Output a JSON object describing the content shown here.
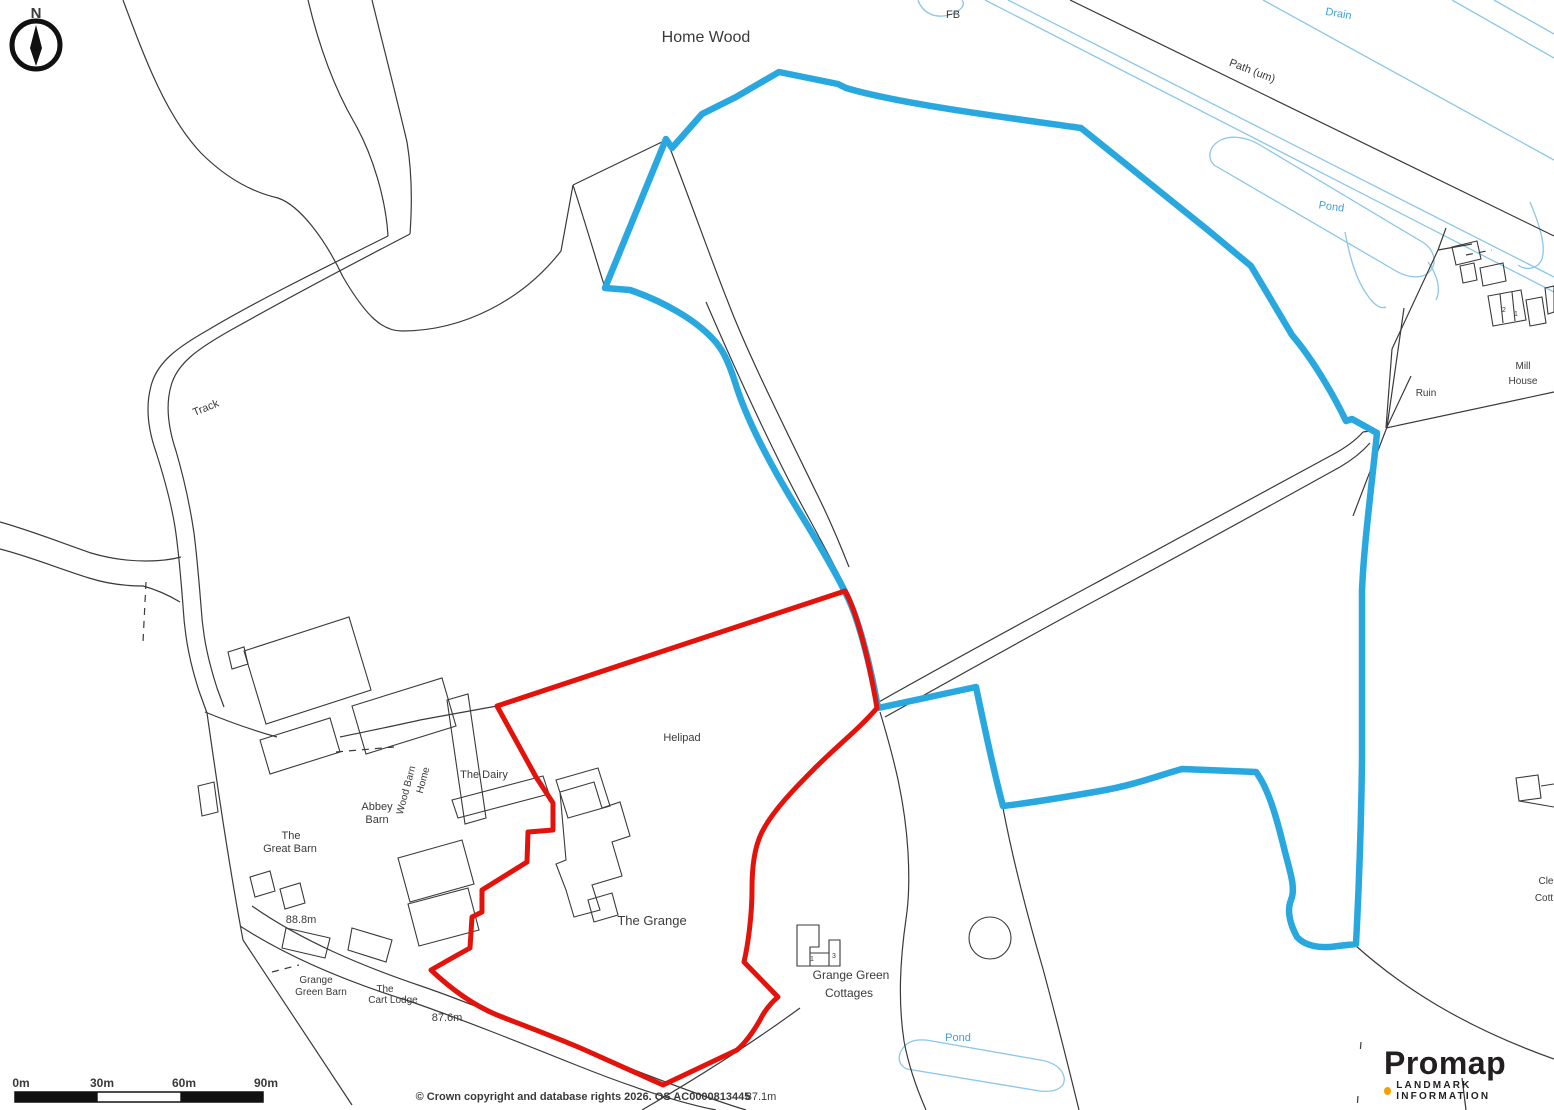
{
  "map": {
    "colors": {
      "ink": "#3a3a3a",
      "water": "#3f9fd6",
      "boundary_red": "#e3120b",
      "boundary_blue": "#29a8e0",
      "drain_blue": "#8cc6e8",
      "logo_dark": "#231f20",
      "logo_orange": "#f5a000"
    },
    "labels": [
      {
        "name": "home-wood",
        "text": "Home Wood",
        "x": 706,
        "y": 42,
        "size": 16
      },
      {
        "name": "fb",
        "text": "FB",
        "x": 953,
        "y": 18,
        "size": 11
      },
      {
        "name": "drain",
        "text": "Drain",
        "x": 1338,
        "y": 17,
        "size": 11,
        "color": "water",
        "rotate": 10
      },
      {
        "name": "path-um",
        "text": "Path (um)",
        "x": 1251,
        "y": 74,
        "size": 11,
        "rotate": 21
      },
      {
        "name": "pond-north",
        "text": "Pond",
        "x": 1331,
        "y": 210,
        "size": 11,
        "color": "water",
        "rotate": 8
      },
      {
        "name": "mill-house-line1",
        "text": "Mill",
        "x": 1523,
        "y": 369,
        "size": 10
      },
      {
        "name": "mill-house-line2",
        "text": "House",
        "x": 1523,
        "y": 384,
        "size": 10
      },
      {
        "name": "ruin",
        "text": "Ruin",
        "x": 1426,
        "y": 396,
        "size": 10
      },
      {
        "name": "millhouse-no-2",
        "text": "2",
        "x": 1504,
        "y": 312,
        "size": 7
      },
      {
        "name": "millhouse-no-1",
        "text": "1",
        "x": 1516,
        "y": 316,
        "size": 7
      },
      {
        "name": "track",
        "text": "Track",
        "x": 207,
        "y": 411,
        "size": 11,
        "rotate": -22
      },
      {
        "name": "helipad",
        "text": "Helipad",
        "x": 682,
        "y": 741,
        "size": 11
      },
      {
        "name": "the-dairy",
        "text": "The Dairy",
        "x": 484,
        "y": 778,
        "size": 11
      },
      {
        "name": "home-wood-barn-word1",
        "text": "Home",
        "x": 426,
        "y": 781,
        "size": 10,
        "rotate": -75
      },
      {
        "name": "home-wood-barn-word2",
        "text": "Wood Barn",
        "x": 409,
        "y": 791,
        "size": 10,
        "rotate": -75
      },
      {
        "name": "abbey-barn-line1",
        "text": "Abbey",
        "x": 377,
        "y": 810,
        "size": 11
      },
      {
        "name": "abbey-barn-line2",
        "text": "Barn",
        "x": 377,
        "y": 823,
        "size": 11
      },
      {
        "name": "great-barn-line1",
        "text": "The",
        "x": 291,
        "y": 839,
        "size": 11
      },
      {
        "name": "great-barn-line2",
        "text": "Great Barn",
        "x": 290,
        "y": 852,
        "size": 11
      },
      {
        "name": "spot-height-88-8",
        "text": "88.8m",
        "x": 301,
        "y": 923,
        "size": 11
      },
      {
        "name": "grange-green-barn-line1",
        "text": "Grange",
        "x": 316,
        "y": 983,
        "size": 10
      },
      {
        "name": "grange-green-barn-line2",
        "text": "Green Barn",
        "x": 321,
        "y": 995,
        "size": 10
      },
      {
        "name": "cart-lodge-line1",
        "text": "The",
        "x": 385,
        "y": 992,
        "size": 10
      },
      {
        "name": "cart-lodge-line2",
        "text": "Cart Lodge",
        "x": 393,
        "y": 1003,
        "size": 10
      },
      {
        "name": "spot-height-87-6",
        "text": "87.6m",
        "x": 447,
        "y": 1021,
        "size": 11
      },
      {
        "name": "the-grange",
        "text": "The Grange",
        "x": 652,
        "y": 925,
        "size": 13
      },
      {
        "name": "cottages-line1",
        "text": "Grange Green",
        "x": 851,
        "y": 979,
        "size": 12
      },
      {
        "name": "cottages-line2",
        "text": "Cottages",
        "x": 849,
        "y": 997,
        "size": 12
      },
      {
        "name": "cottage-no-1",
        "text": "1",
        "x": 812,
        "y": 961,
        "size": 7
      },
      {
        "name": "cottage-no-3",
        "text": "3",
        "x": 834,
        "y": 958,
        "size": 7
      },
      {
        "name": "pond-south",
        "text": "Pond",
        "x": 958,
        "y": 1041,
        "size": 11,
        "color": "water"
      },
      {
        "name": "spot-height-87-1",
        "text": "87.1m",
        "x": 761,
        "y": 1100,
        "size": 11
      },
      {
        "name": "edge-fragment-1",
        "text": "Cle",
        "x": 1546,
        "y": 884,
        "size": 10
      },
      {
        "name": "edge-fragment-2",
        "text": "Cott",
        "x": 1544,
        "y": 901,
        "size": 10
      },
      {
        "name": "attribution",
        "text": "© Crown copyright and database rights 2026. OS AC0000813445",
        "x": 583,
        "y": 1100,
        "size": 11,
        "bold": true
      },
      {
        "name": "compass-n",
        "text": "N",
        "x": 36,
        "y": 18,
        "size": 15,
        "bold": true
      },
      {
        "name": "scale-tick-0",
        "text": "0m",
        "x": 21,
        "y": 1087,
        "size": 12,
        "bold": true
      },
      {
        "name": "scale-tick-30",
        "text": "30m",
        "x": 102,
        "y": 1087,
        "size": 12,
        "bold": true
      },
      {
        "name": "scale-tick-60",
        "text": "60m",
        "x": 184,
        "y": 1087,
        "size": 12,
        "bold": true
      },
      {
        "name": "scale-tick-90",
        "text": "90m",
        "x": 266,
        "y": 1087,
        "size": 12,
        "bold": true
      }
    ]
  },
  "logo": {
    "brand": "Promap",
    "tagline": "LANDMARK INFORMATION"
  }
}
